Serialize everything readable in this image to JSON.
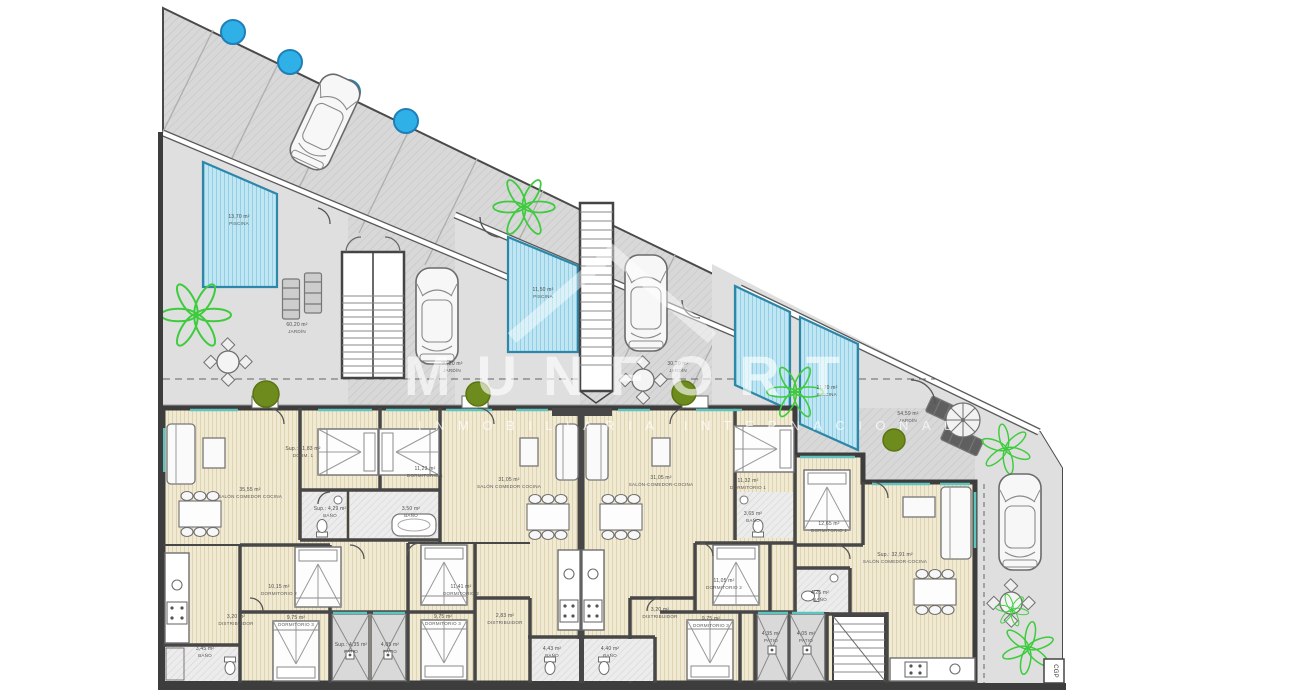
{
  "watermark": {
    "title": "MUNFORT",
    "subtitle": "INMOBILIARIA INTERNACIONAL"
  },
  "plan": {
    "site_labels": [
      {
        "id": "piscina-1",
        "area": "13,70 m²",
        "name": "PISCINA"
      },
      {
        "id": "jardin-1",
        "area": "60,20 m²",
        "name": "JARDÍN"
      },
      {
        "id": "piscina-2",
        "area": "11,50 m²",
        "name": "PISCINA"
      },
      {
        "id": "jardin-2",
        "area": "30,20 m²",
        "name": "JARDÍN"
      },
      {
        "id": "jardin-3",
        "area": "30,20 m²",
        "name": "JARDÍN"
      },
      {
        "id": "piscina-3",
        "area": "11,70 m²",
        "name": "PISCINA"
      },
      {
        "id": "jardin-4",
        "area": "54,59 m²",
        "name": "JARDÍN"
      }
    ],
    "units": [
      {
        "id": "vivienda-1",
        "rooms": [
          {
            "area": "35,55 m²",
            "name": "SALÓN COMEDOR COCINA"
          },
          {
            "area": "Sup.: 11,83 m²",
            "name": "DORM. 1"
          },
          {
            "area": "Sup.: 4,29 m²",
            "name": "BAÑO"
          },
          {
            "area": "10,15 m²",
            "name": "DORMITORIO 2"
          },
          {
            "area": "3,20 m²",
            "name": "DISTRIBUIDOR"
          },
          {
            "area": "9,75 m²",
            "name": "DORMITORIO 3"
          },
          {
            "area": "3,45 m²",
            "name": "BAÑO"
          },
          {
            "area": "Sup.: 4,35 m²",
            "name": "PATIO"
          },
          {
            "area": "4,05 m²",
            "name": "PATIO"
          }
        ]
      },
      {
        "id": "vivienda-2",
        "rooms": [
          {
            "area": "31,05 m²",
            "name": "SALÓN COMEDOR COCINA"
          },
          {
            "area": "11,23 m²",
            "name": "DORMITORIO 1"
          },
          {
            "area": "3,50 m²",
            "name": "BAÑO"
          },
          {
            "area": "11,41 m²",
            "name": "DORMITORIO 2"
          },
          {
            "area": "2,83 m²",
            "name": "DISTRIBUIDOR"
          },
          {
            "area": "9,75 m²",
            "name": "DORMITORIO 3"
          },
          {
            "area": "4,43 m²",
            "name": "BAÑO"
          }
        ]
      },
      {
        "id": "vivienda-3",
        "rooms": [
          {
            "area": "31,05 m²",
            "name": "SALÓN-COMEDOR-COCINA"
          },
          {
            "area": "11,32 m²",
            "name": "DORMITORIO 1"
          },
          {
            "area": "3,65 m²",
            "name": "BAÑO"
          },
          {
            "area": "11,05 m²",
            "name": "DORMITORIO 2"
          },
          {
            "area": "3,20 m²",
            "name": "DISTRIBUIDOR"
          },
          {
            "area": "9,75 m²",
            "name": "DORMITORIO 3"
          },
          {
            "area": "4,40 m²",
            "name": "BAÑO"
          },
          {
            "area": "4,35 m²",
            "name": "PATIO"
          },
          {
            "area": "4,05 m²",
            "name": "PATIO"
          }
        ]
      },
      {
        "id": "vivienda-4",
        "rooms": [
          {
            "area": "Sup.: 32,91 m²",
            "name": "SALÓN COMEDOR-COCINA"
          },
          {
            "area": "12,65 m²",
            "name": "DORMITORIO 1"
          },
          {
            "area": "4,25 m²",
            "name": "BAÑO"
          }
        ]
      }
    ],
    "utility_box": "CGP"
  },
  "colors": {
    "paving": "#d8d8d8",
    "garden": "#dfdfdf",
    "pool_fill": "#bfe6f2",
    "pool_edge": "#2e86a8",
    "floor": "#f1ead3",
    "wall": "#474747",
    "accent_teal": "#5fc4bd",
    "tree_blue": "#2fb1e8",
    "tree_olive": "#6e8b1e",
    "palm_green": "#3ecb3e",
    "watermark": "#ffffff"
  }
}
